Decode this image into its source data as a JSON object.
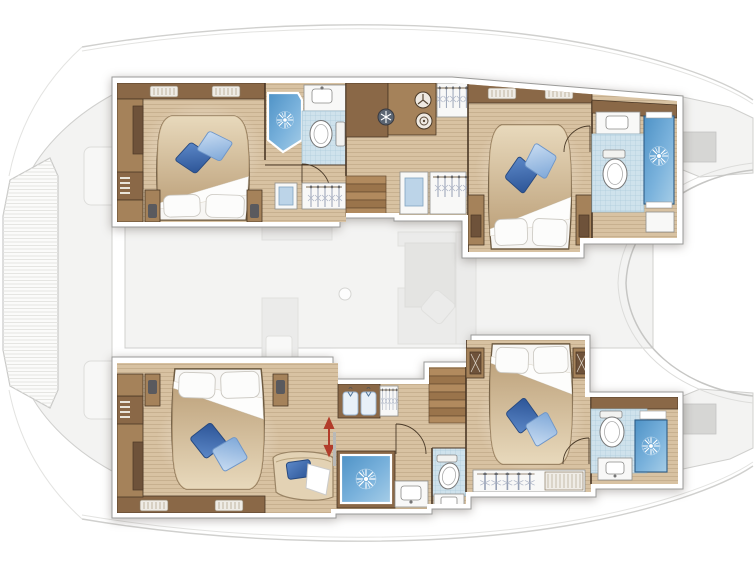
{
  "page": {
    "canvas_width": 755,
    "canvas_height": 566,
    "background": "#ffffff"
  },
  "palette": {
    "wood": "#d8c2a2",
    "woodDk": "#c3a987",
    "cabBrown": "#8a6847",
    "cabLt": "#a5825a",
    "lineDk": "#4a3725",
    "paperWhite": "#f8f8f7",
    "hullBorder": "#9a9a98",
    "tile": "#cfe2ec",
    "tileLine": "#aecbdc",
    "shower1": "#4e92c6",
    "shower2": "#a6cde7",
    "pillowDk": "#3f6db3",
    "pillowLt": "#a9c7ec",
    "spread1": "#e8d9bc",
    "spread2": "#bfa47e",
    "fadedFill": "#f3f3f2",
    "fadedLine": "#d0d0ce",
    "fadedFurn": "#ebebea",
    "grayHatch": "#d6d6d4",
    "redArrow": "#b23c2a"
  },
  "plan": {
    "subject": "catamaran-interior-floor-plan",
    "layout_version": "4-cabin",
    "orientation": "bow-left",
    "port_hull": {
      "position": "top",
      "rooms": [
        {
          "name": "forward-cabin",
          "features": [
            "island-double-bed",
            "white-pillows",
            "blue-throw-cushions",
            "side-cabinets",
            "nightstands",
            "vent-grills"
          ]
        },
        {
          "name": "forward-head",
          "features": [
            "corner-shower",
            "washbasin",
            "toilet",
            "door-swing"
          ]
        },
        {
          "name": "companionway",
          "features": [
            "stairs-to-saloon",
            "fridge-snowflake",
            "washer",
            "dryer",
            "hanging-lockers",
            "vanity-nooks"
          ]
        },
        {
          "name": "aft-cabin",
          "features": [
            "island-double-bed",
            "white-pillows",
            "blue-throw-cushions",
            "nightstands",
            "vent-grills",
            "door-swing"
          ]
        },
        {
          "name": "aft-head",
          "features": [
            "washbasin",
            "toilet",
            "shower",
            "cabinet"
          ]
        }
      ]
    },
    "starboard_hull": {
      "position": "bottom",
      "rooms": [
        {
          "name": "forward-cabin",
          "features": [
            "island-double-bed",
            "white-pillows",
            "blue-throw-cushions",
            "chaise-seat",
            "sliding-door-arrow",
            "side-cabinets",
            "vent-grills"
          ]
        },
        {
          "name": "forward-head",
          "features": [
            "shower",
            "washbasin",
            "toilet-room",
            "door-swing"
          ]
        },
        {
          "name": "companionway",
          "features": [
            "stairs-to-saloon",
            "shirt-locker",
            "hanging-locker"
          ]
        },
        {
          "name": "aft-cabin",
          "features": [
            "island-double-bed",
            "white-pillows",
            "blue-throw-cushions",
            "nightstands",
            "hanging-locker",
            "door-swing"
          ]
        },
        {
          "name": "aft-head",
          "features": [
            "toilet",
            "shower",
            "washbasin"
          ]
        }
      ]
    },
    "faded_deck": {
      "areas": [
        "bow-trampoline",
        "foredeck-sunpads",
        "saloon-sofa",
        "saloon-table",
        "galley-counter",
        "galley-sink",
        "mast-step",
        "port-transom",
        "starboard-transom",
        "aft-cockpit-cutout",
        "deck-rails"
      ]
    }
  },
  "icons": {
    "shower_rose": "white-starburst",
    "wardrobe": "clothes-hangers-on-rail",
    "shirt_locker": "two-hanging-shirts",
    "fridge": "snowflake-circle",
    "washer": "drum-circle",
    "dryer": "dial-circle",
    "door": "quarter-arc-swing",
    "sliding_door": "red-double-headed-arrow",
    "stairs": "wood-treads"
  }
}
